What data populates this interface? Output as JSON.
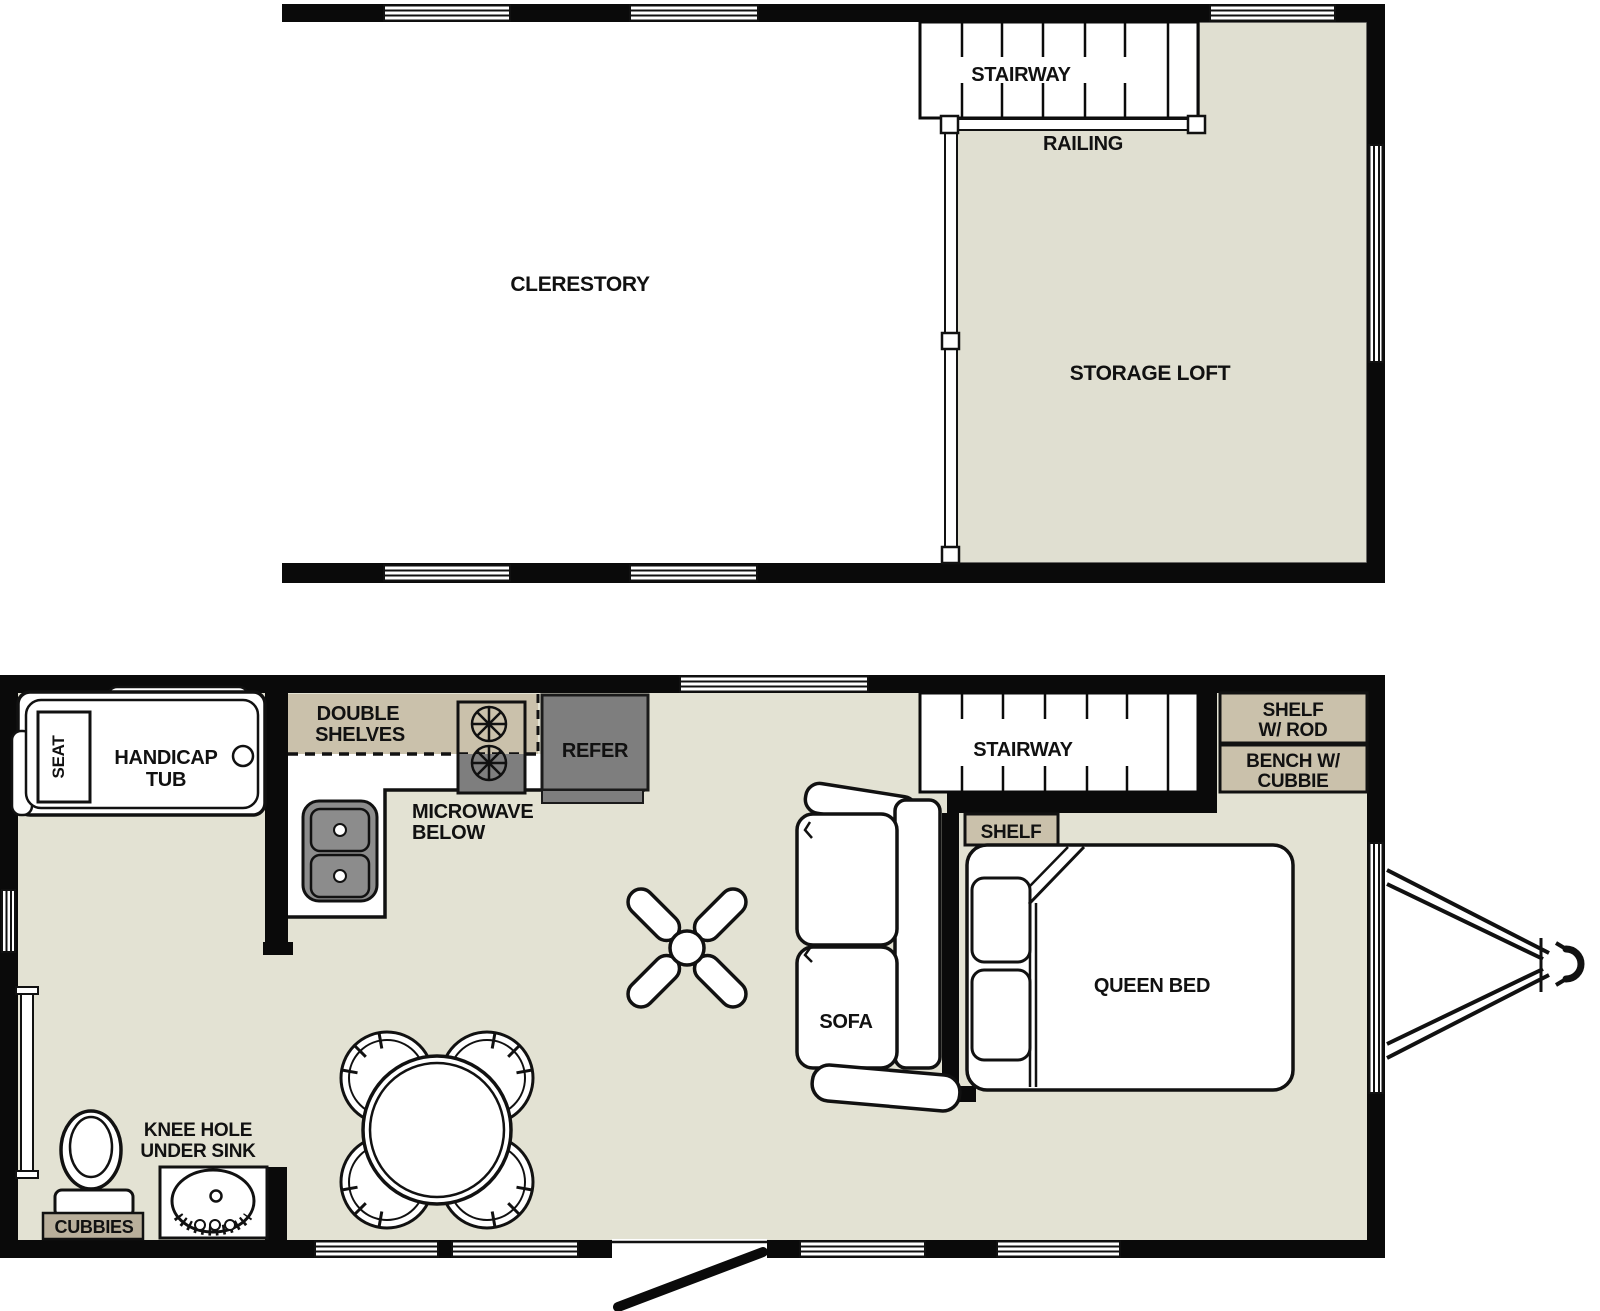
{
  "document_type": "tiny-home floor plan, two levels",
  "colors": {
    "wall": "#0a0a0a",
    "floor_beige": "#e3e2d3",
    "loft_beige": "#e0dfd1",
    "cabinet_tan": "#cac1ab",
    "cubbies_tan": "#b9af9b",
    "appliance_gray": "#7e7e7e",
    "sink_gray": "#8c8c8c",
    "outline": "#111111"
  },
  "upper_level": {
    "clerestory": "CLERESTORY",
    "stairway": "STAIRWAY",
    "railing": "RAILING",
    "storage_loft": "STORAGE LOFT"
  },
  "main_level": {
    "seat": "SEAT",
    "handicap_tub_line1": "HANDICAP",
    "handicap_tub_line2": "TUB",
    "double_shelves_line1": "DOUBLE",
    "double_shelves_line2": "SHELVES",
    "microwave_line1": "MICROWAVE",
    "microwave_line2": "BELOW",
    "refer": "REFER",
    "stairway": "STAIRWAY",
    "shelf_w_rod_line1": "SHELF",
    "shelf_w_rod_line2": "W/ ROD",
    "bench_line1": "BENCH W/",
    "bench_line2": "CUBBIE",
    "shelf": "SHELF",
    "queen_bed": "QUEEN BED",
    "sofa": "SOFA",
    "knee_hole_line1": "KNEE HOLE",
    "knee_hole_line2": "UNDER SINK",
    "cubbies": "CUBBIES"
  }
}
